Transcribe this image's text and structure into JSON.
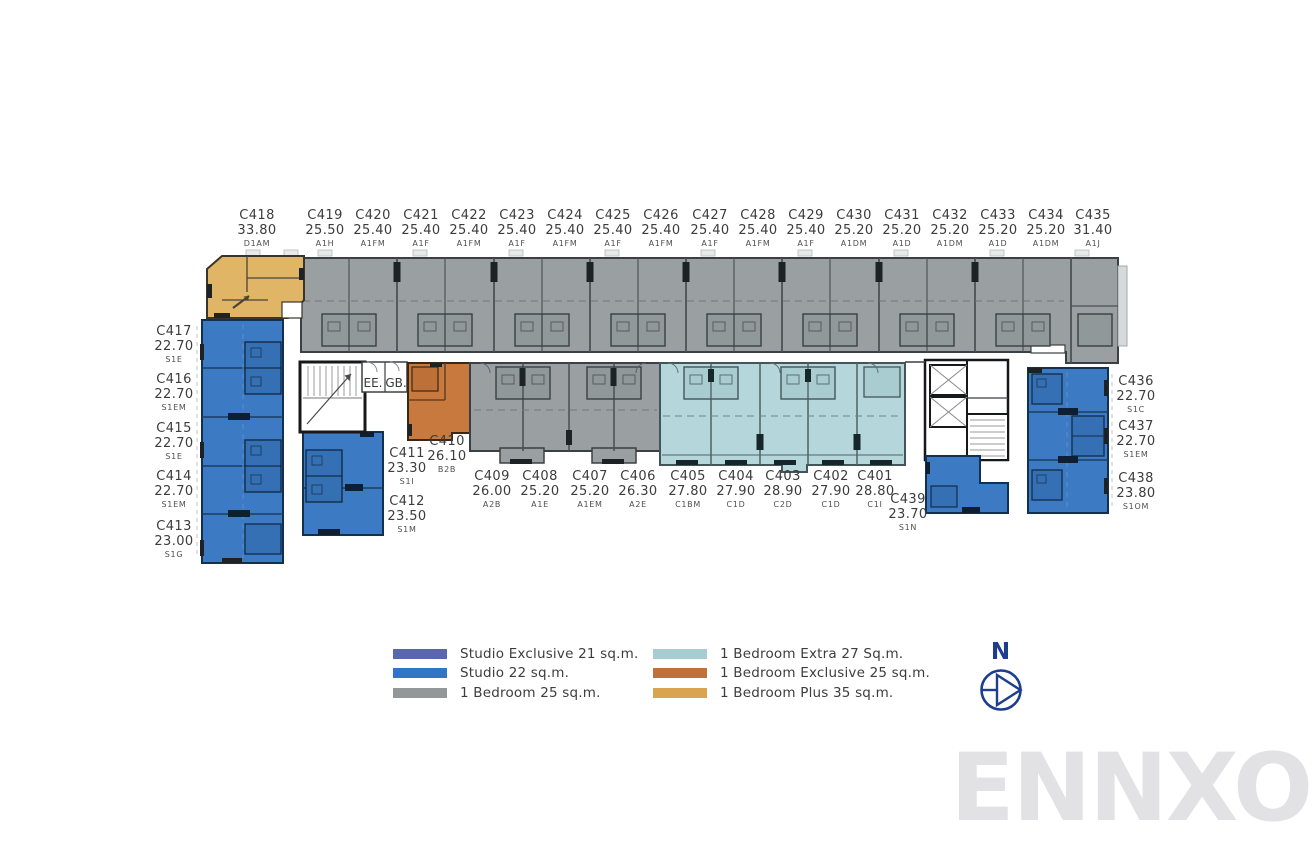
{
  "page": {
    "background": "#ffffff"
  },
  "watermark": {
    "text": "ENNXO",
    "color": "#e2e2e4"
  },
  "compass": {
    "label": "N",
    "color": "#1d3d8f"
  },
  "core": {
    "ee": "EE.",
    "gb": "GB."
  },
  "legend": {
    "items": [
      {
        "label": "Studio Exclusive 21 sq.m.",
        "color": "#5b67ad"
      },
      {
        "label": "Studio 22 sq.m.",
        "color": "#3076c6"
      },
      {
        "label": "1 Bedroom 25 sq.m.",
        "color": "#939798"
      },
      {
        "label": "1 Bedroom Extra 27 Sq.m.",
        "color": "#a6cdd2"
      },
      {
        "label": "1 Bedroom Exclusive 25 sq.m.",
        "color": "#c26f3a"
      },
      {
        "label": "1 Bedroom Plus 35 sq.m.",
        "color": "#d9a34f"
      }
    ]
  },
  "plan_colors": {
    "studio": "#3d7ac4",
    "studio_exclusive": "#5b67ad",
    "one_bedroom": "#9aa0a1",
    "one_bedroom_extra": "#b5d6da",
    "one_bedroom_exclusive": "#c8793e",
    "one_bedroom_plus": "#e1b566",
    "walls": "#3a4043",
    "core_white": "#ffffff"
  },
  "units": [
    {
      "id": "C418",
      "area": "33.80",
      "type": "D1AM"
    },
    {
      "id": "C419",
      "area": "25.50",
      "type": "A1H"
    },
    {
      "id": "C420",
      "area": "25.40",
      "type": "A1FM"
    },
    {
      "id": "C421",
      "area": "25.40",
      "type": "A1F"
    },
    {
      "id": "C422",
      "area": "25.40",
      "type": "A1FM"
    },
    {
      "id": "C423",
      "area": "25.40",
      "type": "A1F"
    },
    {
      "id": "C424",
      "area": "25.40",
      "type": "A1FM"
    },
    {
      "id": "C425",
      "area": "25.40",
      "type": "A1F"
    },
    {
      "id": "C426",
      "area": "25.40",
      "type": "A1FM"
    },
    {
      "id": "C427",
      "area": "25.40",
      "type": "A1F"
    },
    {
      "id": "C428",
      "area": "25.40",
      "type": "A1FM"
    },
    {
      "id": "C429",
      "area": "25.40",
      "type": "A1F"
    },
    {
      "id": "C430",
      "area": "25.20",
      "type": "A1DM"
    },
    {
      "id": "C431",
      "area": "25.20",
      "type": "A1D"
    },
    {
      "id": "C432",
      "area": "25.20",
      "type": "A1DM"
    },
    {
      "id": "C433",
      "area": "25.20",
      "type": "A1D"
    },
    {
      "id": "C434",
      "area": "25.20",
      "type": "A1DM"
    },
    {
      "id": "C435",
      "area": "31.40",
      "type": "A1J"
    },
    {
      "id": "C417",
      "area": "22.70",
      "type": "S1E"
    },
    {
      "id": "C416",
      "area": "22.70",
      "type": "S1EM"
    },
    {
      "id": "C415",
      "area": "22.70",
      "type": "S1E"
    },
    {
      "id": "C414",
      "area": "22.70",
      "type": "S1EM"
    },
    {
      "id": "C413",
      "area": "23.00",
      "type": "S1G"
    },
    {
      "id": "C411",
      "area": "23.30",
      "type": "S1I"
    },
    {
      "id": "C412",
      "area": "23.50",
      "type": "S1M"
    },
    {
      "id": "C410",
      "area": "26.10",
      "type": "B2B"
    },
    {
      "id": "C409",
      "area": "26.00",
      "type": "A2B"
    },
    {
      "id": "C408",
      "area": "25.20",
      "type": "A1E"
    },
    {
      "id": "C407",
      "area": "25.20",
      "type": "A1EM"
    },
    {
      "id": "C406",
      "area": "26.30",
      "type": "A2E"
    },
    {
      "id": "C405",
      "area": "27.80",
      "type": "C1BM"
    },
    {
      "id": "C404",
      "area": "27.90",
      "type": "C1D"
    },
    {
      "id": "C403",
      "area": "28.90",
      "type": "C2D"
    },
    {
      "id": "C402",
      "area": "27.90",
      "type": "C1D"
    },
    {
      "id": "C401",
      "area": "28.80",
      "type": "C1I"
    },
    {
      "id": "C439",
      "area": "23.70",
      "type": "S1N"
    },
    {
      "id": "C436",
      "area": "22.70",
      "type": "S1C"
    },
    {
      "id": "C437",
      "area": "22.70",
      "type": "S1EM"
    },
    {
      "id": "C438",
      "area": "23.80",
      "type": "S1OM"
    }
  ]
}
